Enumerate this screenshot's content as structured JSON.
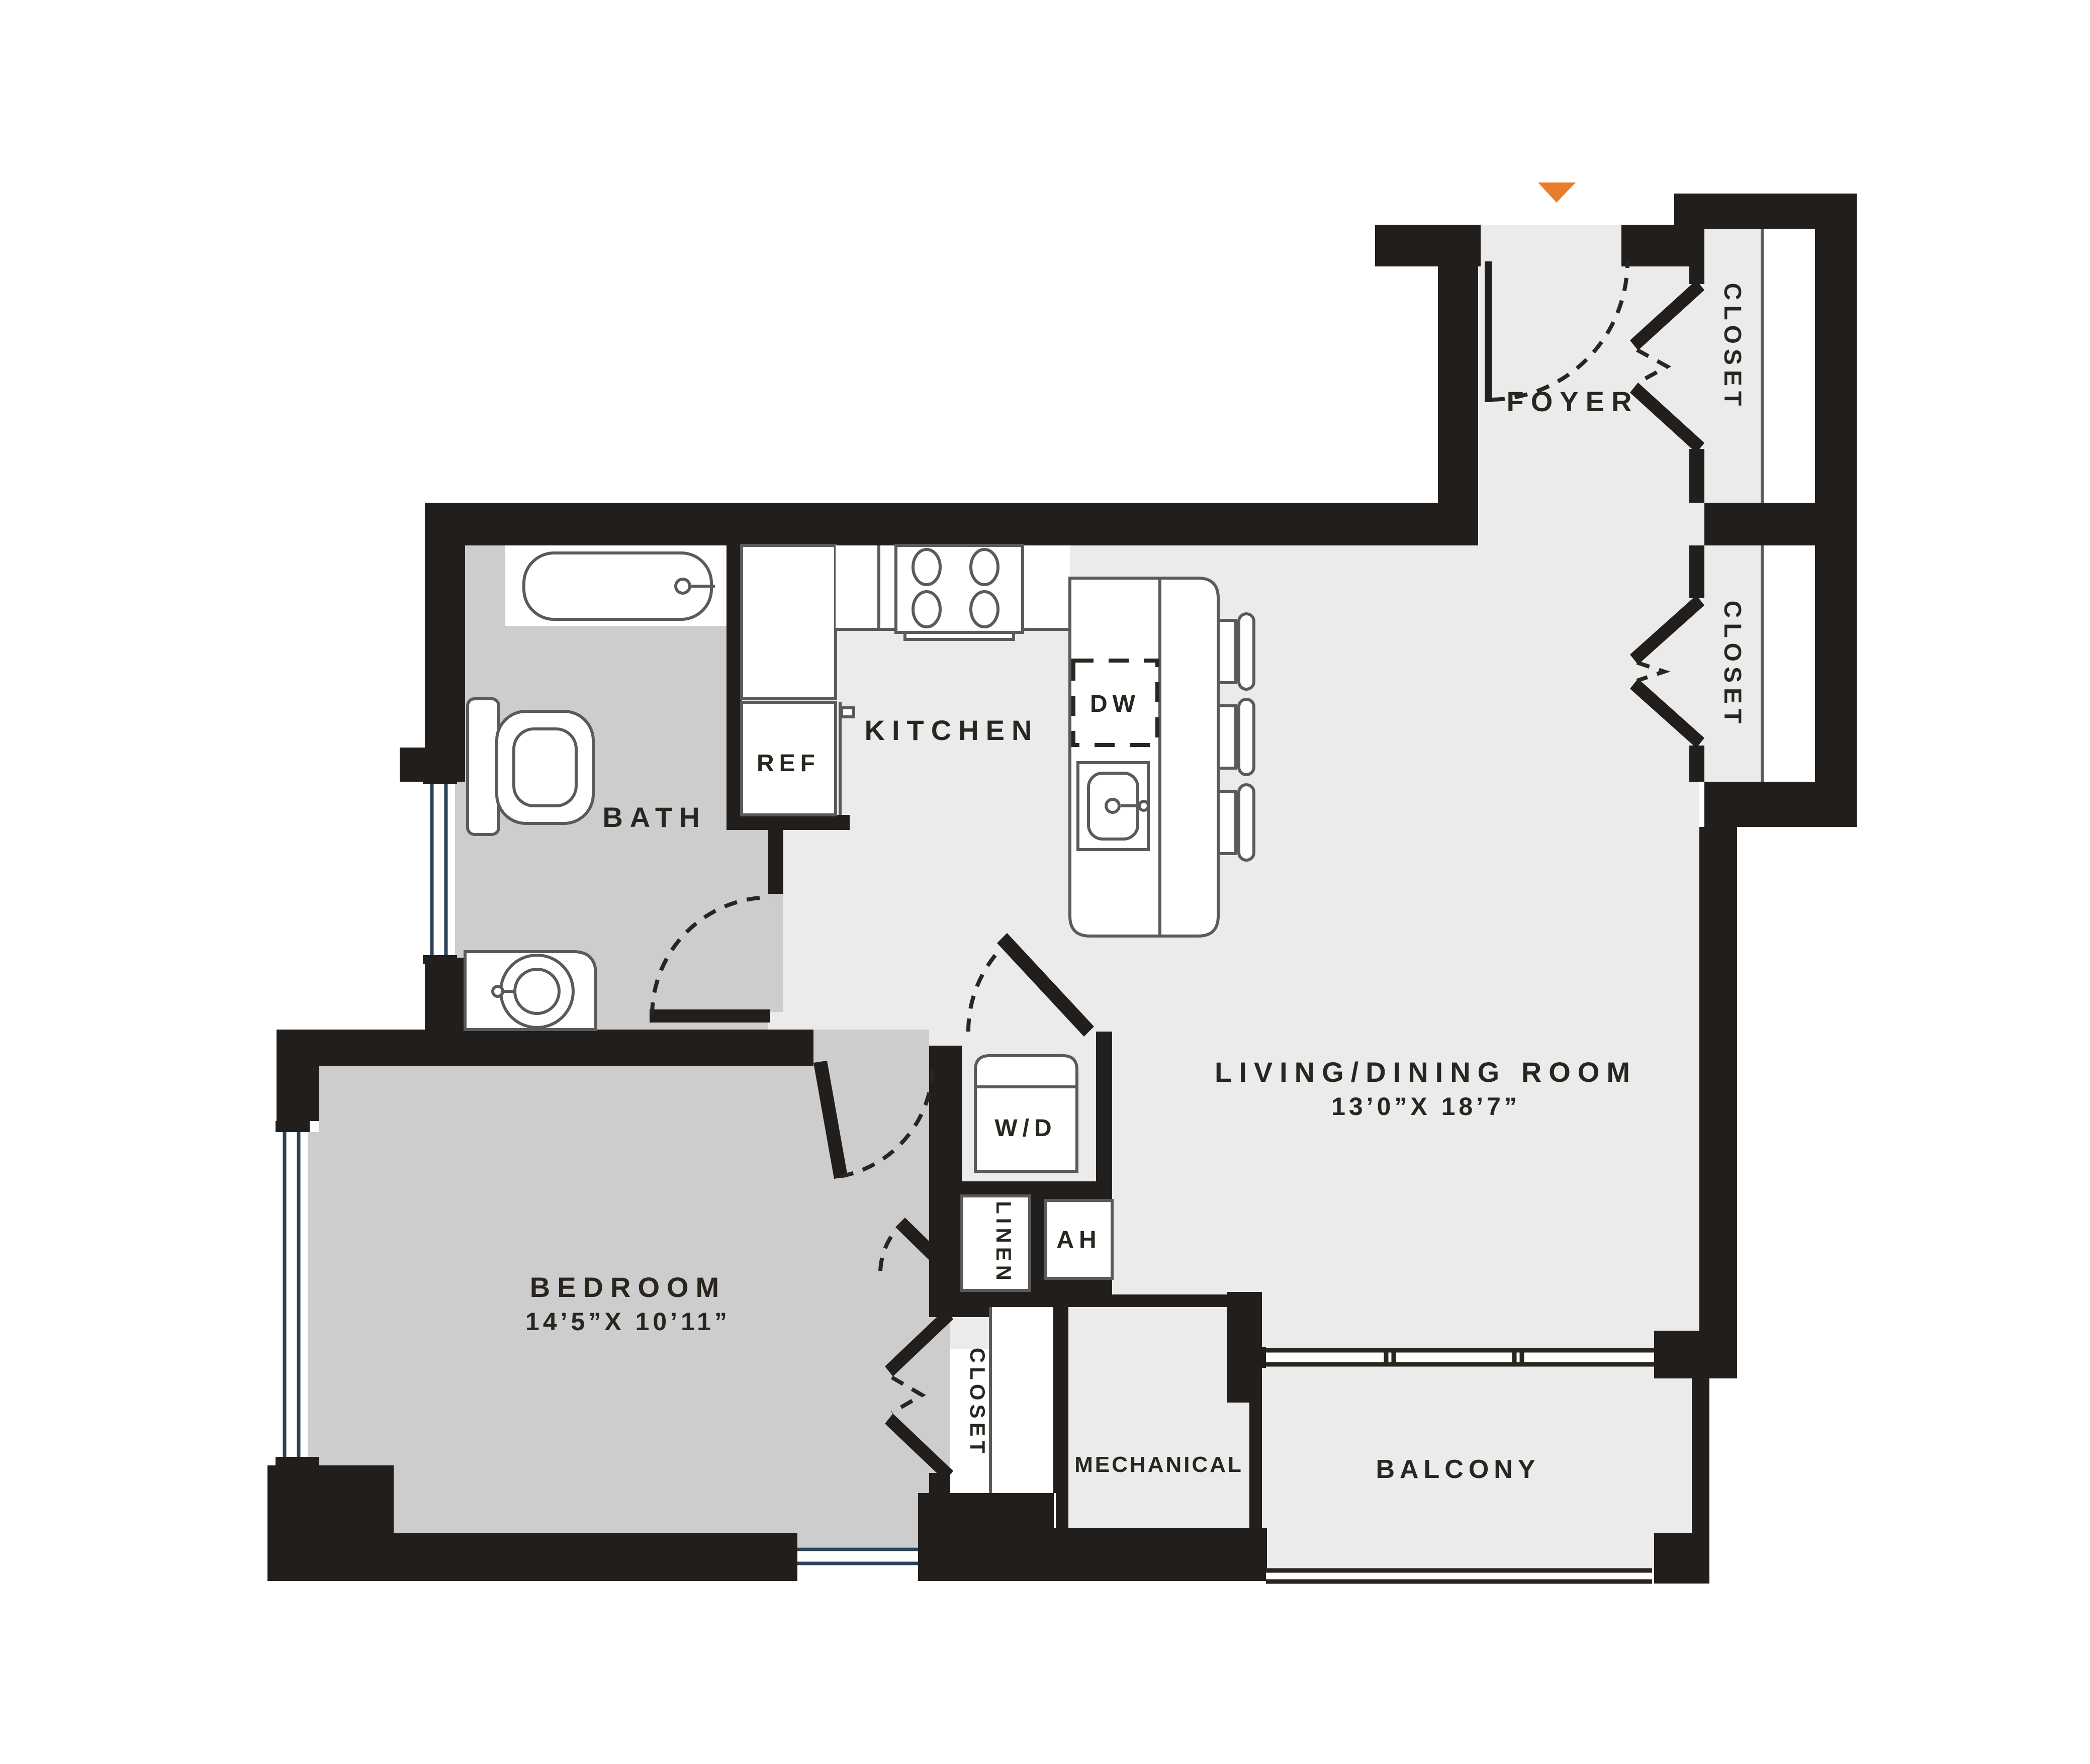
{
  "plan": {
    "type": "apartment-floor-plan",
    "colors": {
      "wall": "#211e1c",
      "floor_light": "#ebebeb",
      "floor_dark": "#cdcdcd",
      "fixture_outline": "#5a5a5a",
      "window_glass_line": "#2c4257",
      "entry_marker": "#e87e2b",
      "text": "#29251f",
      "background": "#ffffff"
    },
    "entry": {
      "marker_icon": "entry-arrow-triangle-down"
    },
    "rooms": {
      "foyer": {
        "label": "FOYER"
      },
      "closet_upper": {
        "label": "CLOSET"
      },
      "closet_lower": {
        "label": "CLOSET"
      },
      "kitchen": {
        "label": "KITCHEN"
      },
      "ref": {
        "label": "REF"
      },
      "dw": {
        "label": "DW"
      },
      "bath": {
        "label": "BATH"
      },
      "living_dining": {
        "label": "LIVING/DINING ROOM",
        "dimensions": "13’0”X 18’7”"
      },
      "bedroom": {
        "label": "BEDROOM",
        "dimensions": "14’5”X 10’11”"
      },
      "wd": {
        "label": "W/D"
      },
      "linen": {
        "label": "LINEN"
      },
      "ah": {
        "label": "AH"
      },
      "bedroom_closet": {
        "label": "CLOSET"
      },
      "mechanical": {
        "label": "MECHANICAL"
      },
      "balcony": {
        "label": "BALCONY"
      }
    }
  }
}
